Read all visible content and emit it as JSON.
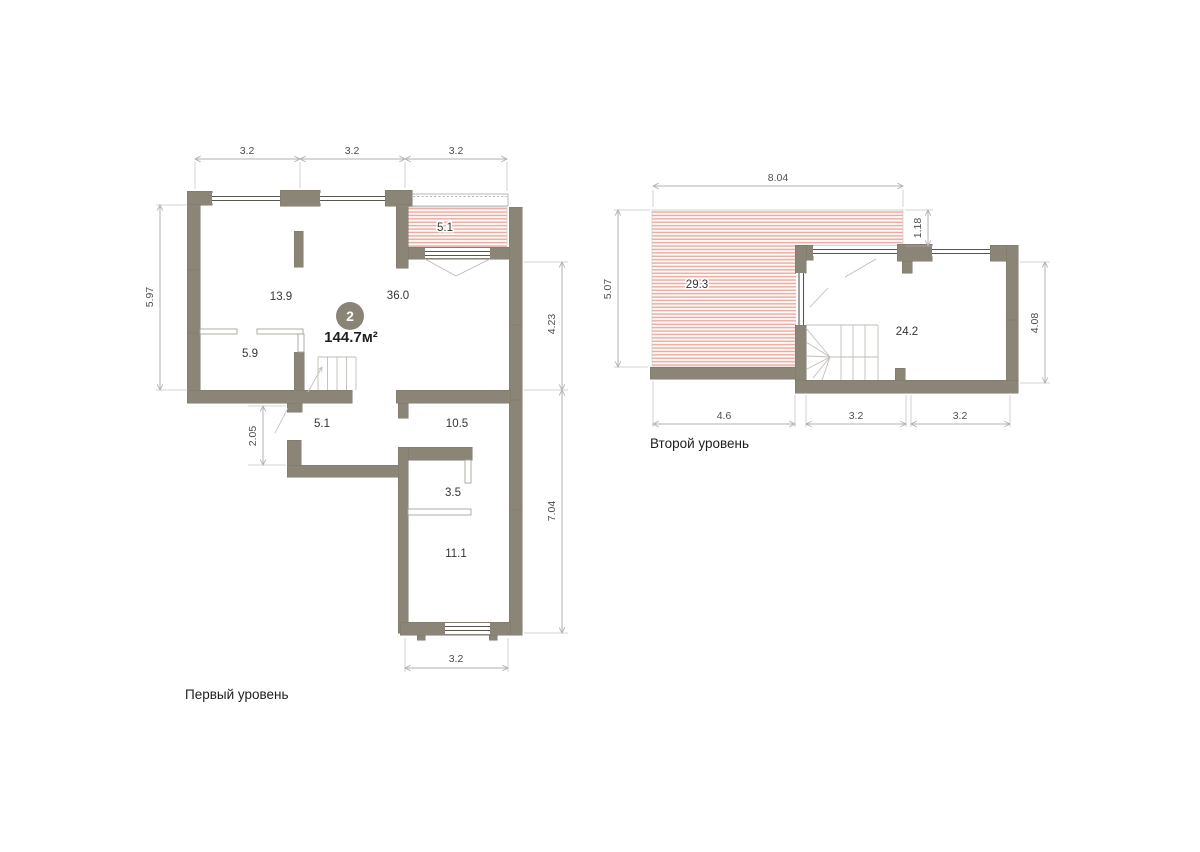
{
  "unit": {
    "number": "2",
    "area": "144.7м²"
  },
  "level1": {
    "caption": "Первый уровень",
    "rooms": {
      "living": "13.9",
      "kitchen_living": "36.0",
      "room_small": "5.9",
      "terrace": "5.1",
      "hall": "5.1",
      "room_105": "10.5",
      "wardrobe": "3.5",
      "room_111": "11.1"
    },
    "dims": {
      "top_1": "3.2",
      "top_2": "3.2",
      "top_3": "3.2",
      "left": "5.97",
      "hall_left": "2.05",
      "right_upper": "4.23",
      "right_lower": "7.04",
      "bottom": "3.2"
    }
  },
  "level2": {
    "caption": "Второй уровень",
    "rooms": {
      "terrace": "29.3",
      "room": "24.2"
    },
    "dims": {
      "top": "8.04",
      "terrace_right": "1.18",
      "left": "5.07",
      "right": "4.08",
      "bottom_1": "4.6",
      "bottom_2": "3.2",
      "bottom_3": "3.2"
    }
  },
  "colors": {
    "wall": "#8b8578",
    "wall-edge": "#7d7669",
    "hatch-line": "#e8a79e",
    "hatch-bg": "#fdf8f6",
    "dim-line": "#b2b2b0",
    "dim-text": "#4e4e4c",
    "room-text": "#343432",
    "area-text": "#1f1f1e",
    "badge": "#8a8476",
    "thin-line": "#a8a39a",
    "window-line": "#565550",
    "stair-line": "#c2beb6",
    "caption-text": "#1e1e1e"
  }
}
